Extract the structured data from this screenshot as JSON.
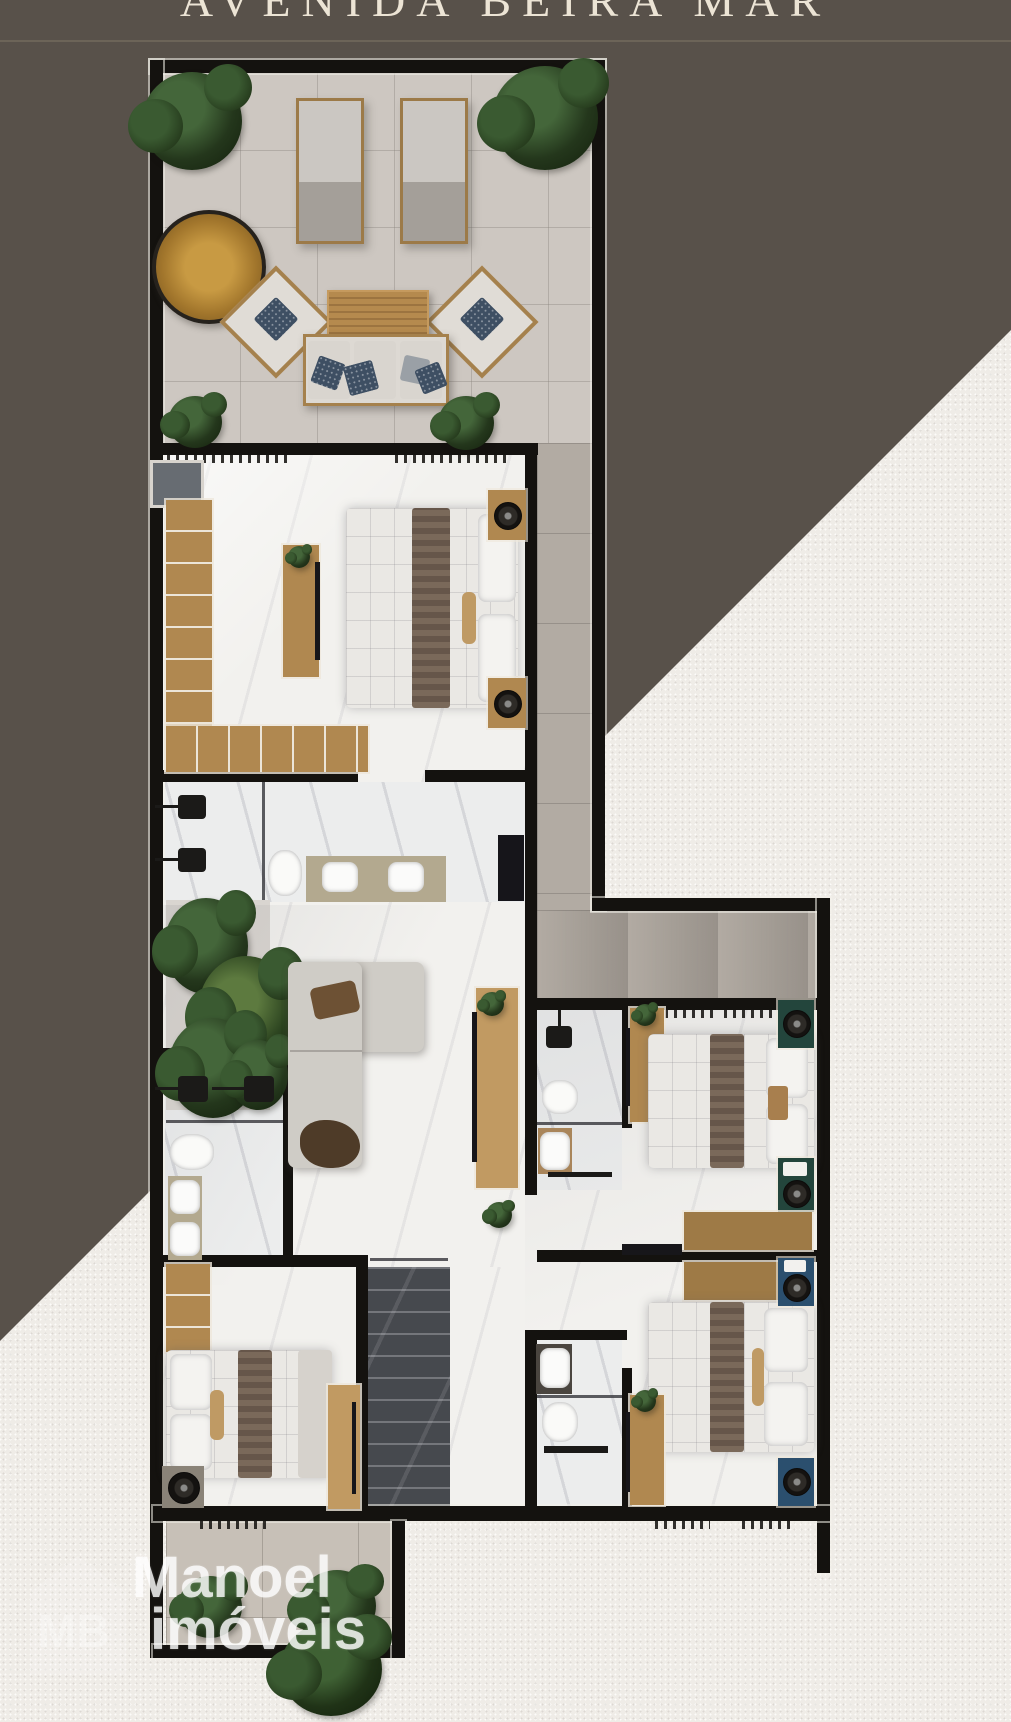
{
  "title": {
    "text": "AVENIDA BEIRA MAR"
  },
  "logo": {
    "line1": "Manoel",
    "line2": "imóveis",
    "monogram": "MB"
  },
  "colors": {
    "wall": "#14120f",
    "brown": "#58514a",
    "band-line": "#6f665a",
    "title": "#ece4d5",
    "terrace": "#cdc7c1",
    "corridor": "#b2aba3",
    "marble": "#f2f1ee",
    "patio": "#c7c0b7",
    "wood": "#b08850",
    "wood-dark": "#9a7440",
    "green-ns": "#23453c",
    "blue-ns": "#2b4f6e",
    "stairs": "#46494e",
    "logo": "#ffffff"
  }
}
